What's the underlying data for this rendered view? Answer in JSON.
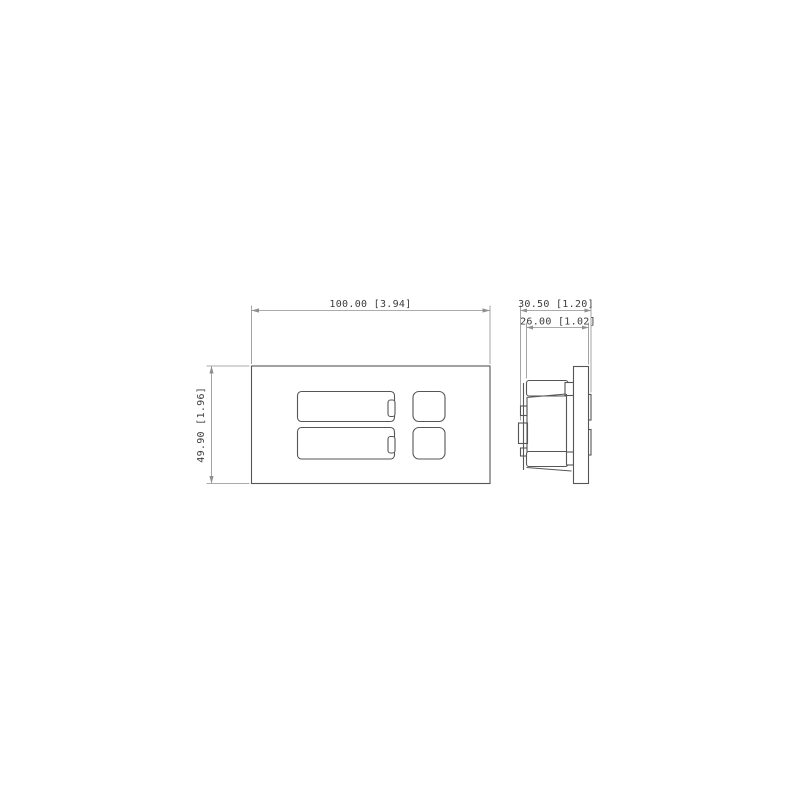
{
  "colors": {
    "bg": "#ffffff",
    "line": "#565656",
    "dim": "#8f8f8f",
    "text": "#3c3c3c"
  },
  "drawing": {
    "type": "technical-dimension-drawing",
    "views": {
      "front": {
        "width_dim": "100.00 [3.94]",
        "height_dim": "49.90 [1.96]"
      },
      "side": {
        "total_depth_dim": "30.50 [1.20]",
        "insert_depth_dim": "26.00 [1.02]"
      }
    }
  }
}
